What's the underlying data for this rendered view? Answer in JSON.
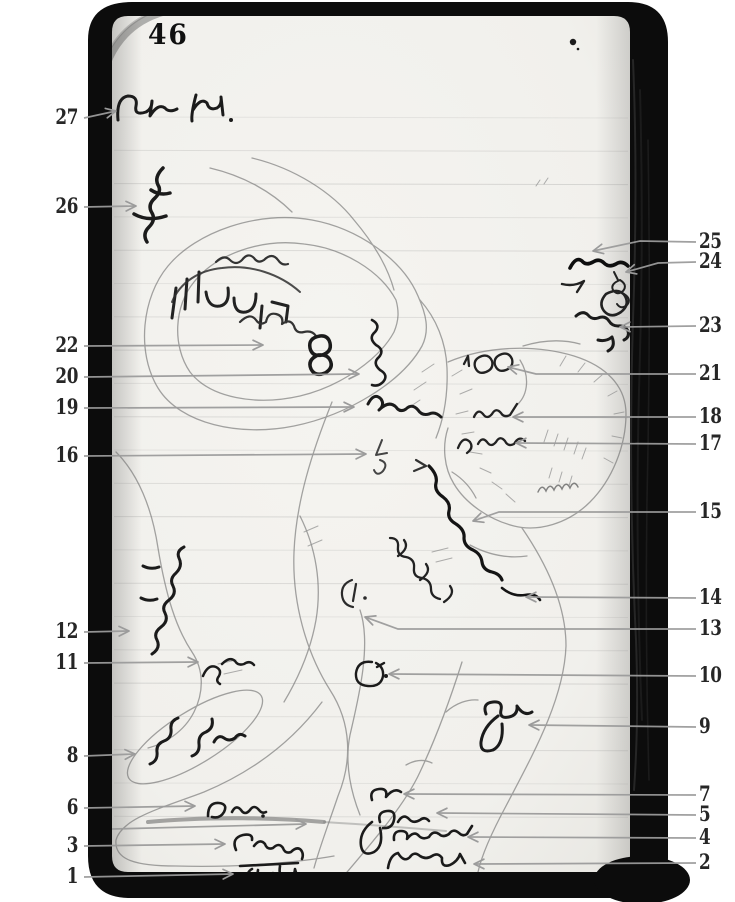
{
  "document": {
    "type": "scanned field-notebook page with hand-drawn pencil sketch map and numbered annotation callouts",
    "page_number": "46"
  },
  "colors": {
    "paper": "#f2f1ed",
    "book_cover": "#0c0c0c",
    "leader_line": "#9b9b9b",
    "callout_text": "#262626",
    "pencil": "#6f6f6f",
    "ink": "#1b1b1b"
  },
  "callouts": [
    {
      "n": "27",
      "side": "left",
      "pts": [
        [
          84,
          118
        ],
        [
          116,
          111
        ]
      ],
      "target": "handwritten heading 'Ruth Pl.'"
    },
    {
      "n": "26",
      "side": "left",
      "pts": [
        [
          84,
          207
        ],
        [
          136,
          206
        ]
      ],
      "target": "diagonal handwritten scrawl"
    },
    {
      "n": "22",
      "side": "left",
      "pts": [
        [
          84,
          346
        ],
        [
          263,
          345
        ]
      ],
      "target": "rotated writing inside hachured ridge"
    },
    {
      "n": "20",
      "side": "left",
      "pts": [
        [
          84,
          377
        ],
        [
          359,
          374
        ]
      ],
      "target": "vertical cursive word"
    },
    {
      "n": "19",
      "side": "left",
      "pts": [
        [
          84,
          408
        ],
        [
          354,
          407
        ]
      ],
      "target": "dark scrawled note"
    },
    {
      "n": "16",
      "side": "left",
      "pts": [
        [
          84,
          456
        ],
        [
          366,
          454
        ]
      ],
      "target": "rotated note"
    },
    {
      "n": "12",
      "side": "left",
      "pts": [
        [
          84,
          632
        ],
        [
          129,
          631
        ]
      ],
      "target": "vertical handwriting on hill"
    },
    {
      "n": "11",
      "side": "left",
      "pts": [
        [
          84,
          663
        ],
        [
          198,
          662
        ]
      ],
      "target": "diagonal word 'Pass'"
    },
    {
      "n": "8",
      "side": "left",
      "pts": [
        [
          84,
          756
        ],
        [
          135,
          754
        ]
      ],
      "target": "handwriting inside outlined area"
    },
    {
      "n": "6",
      "side": "left",
      "pts": [
        [
          84,
          808
        ],
        [
          195,
          806
        ]
      ],
      "target": "note '5 m.'"
    },
    {
      "n": "3",
      "side": "left",
      "pts": [
        [
          84,
          846
        ],
        [
          225,
          844
        ]
      ],
      "target": "word 'Chaves'"
    },
    {
      "n": "1",
      "side": "left",
      "pts": [
        [
          84,
          877
        ],
        [
          233,
          874
        ]
      ],
      "target": "overlined handwritten word"
    },
    {
      "n": "25",
      "side": "right",
      "pts": [
        [
          696,
          242
        ],
        [
          640,
          241
        ],
        [
          593,
          251
        ]
      ],
      "target": "dark scrawl"
    },
    {
      "n": "24",
      "side": "right",
      "pts": [
        [
          696,
          262
        ],
        [
          658,
          263
        ],
        [
          626,
          272
        ]
      ],
      "target": "small diagonal '100'"
    },
    {
      "n": "23",
      "side": "right",
      "pts": [
        [
          696,
          326
        ],
        [
          620,
          327
        ]
      ],
      "target": "diagonal scrawl"
    },
    {
      "n": "21",
      "side": "right",
      "pts": [
        [
          696,
          374
        ],
        [
          536,
          374
        ],
        [
          508,
          367
        ]
      ],
      "target": "note '100'"
    },
    {
      "n": "18",
      "side": "right",
      "pts": [
        [
          696,
          417
        ],
        [
          513,
          417
        ]
      ],
      "target": "handwritten note"
    },
    {
      "n": "17",
      "side": "right",
      "pts": [
        [
          696,
          444
        ],
        [
          516,
          443
        ]
      ],
      "target": "note '5 mls'"
    },
    {
      "n": "15",
      "side": "right",
      "pts": [
        [
          696,
          512
        ],
        [
          499,
          512
        ],
        [
          473,
          521
        ]
      ],
      "target": "dark wavy stream line"
    },
    {
      "n": "14",
      "side": "right",
      "pts": [
        [
          696,
          598
        ],
        [
          526,
          597
        ]
      ],
      "target": "cursive name along stream"
    },
    {
      "n": "13",
      "side": "right",
      "pts": [
        [
          696,
          629
        ],
        [
          398,
          629
        ],
        [
          365,
          617
        ]
      ],
      "target": "small circle mark"
    },
    {
      "n": "10",
      "side": "right",
      "pts": [
        [
          696,
          676
        ],
        [
          389,
          674
        ]
      ],
      "target": "small circle with dot"
    },
    {
      "n": "9",
      "side": "right",
      "pts": [
        [
          696,
          727
        ],
        [
          529,
          725
        ]
      ],
      "target": "abbreviation with loop"
    },
    {
      "n": "7",
      "side": "right",
      "pts": [
        [
          696,
          795
        ],
        [
          404,
          794
        ]
      ],
      "target": "word 'or'"
    },
    {
      "n": "5",
      "side": "right",
      "pts": [
        [
          696,
          815
        ],
        [
          437,
          813
        ]
      ],
      "target": "handwritten abbreviation"
    },
    {
      "n": "4",
      "side": "right",
      "pts": [
        [
          696,
          838
        ],
        [
          468,
          837
        ]
      ],
      "target": "word 'granite'"
    },
    {
      "n": "2",
      "side": "right",
      "pts": [
        [
          696,
          863
        ],
        [
          474,
          864
        ]
      ],
      "target": "handwritten word"
    }
  ],
  "extra_leader": {
    "pts": [
      [
        112,
        829
      ],
      [
        306,
        824
      ]
    ],
    "target": "heavy pencil line above 'Chaves'"
  },
  "ruling": {
    "first_y": 117,
    "last_y": 849,
    "spacing": 33.3,
    "x1": 114,
    "x2": 628
  }
}
